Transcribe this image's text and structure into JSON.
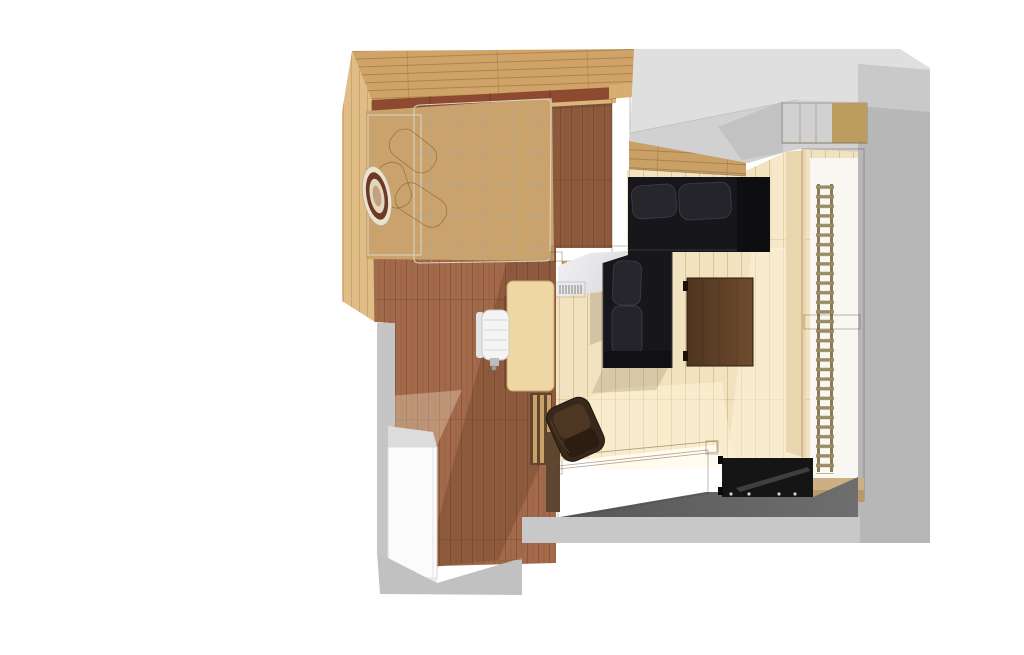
{
  "scene": {
    "title": "3D top-down floor plan render of a studio attic apartment",
    "style": "sketchup-like architectural rendering on white background"
  },
  "objects": {
    "bedroom_floor": "dark wood plank floor of sleeping area",
    "living_floor": "light cream wood floor of living area",
    "bed": "double bed with white quilted duvet",
    "mattress": "white sheet section of bed",
    "pillow": "caramel leather pillow",
    "hat": "round striped hat on bed",
    "balustrade": "wood loft railing beside bed",
    "knee_wall": "wood plank knee wall behind sofa",
    "sofa": "black L-shaped corner sofa",
    "coffee_table": "dark walnut coffee table",
    "lounge_chair": "brown leather lounge chair",
    "desk": "small light wood desk",
    "office_chair": "white office chair",
    "radiator": "small white radiator grille",
    "staircase": "wood staircase to lower level",
    "stair_rail": "wood stair handrail",
    "sideboard": "black lowboard at stair landing",
    "wardrobe": "white wardrobe cabinet",
    "window": "tall window with ladder rail",
    "wall_cabinet": "wood wall cabinet above window",
    "ceiling": "sloped gray attic ceiling planes",
    "lower_floor": "dark gray lower landing floor"
  },
  "colors": {
    "band_top": "#d0a468",
    "band_knee": "#c9a066",
    "strip_left": "#dfbd85",
    "wall_bed": "#8d4a31",
    "sill": "#d9b67c",
    "bed_frame": "#c9a36b",
    "floor_bedroom": "#a26a4b",
    "floor_living": "#f2e3c0",
    "rail_wood": "#d6ae72",
    "rail_gap": "#6e4a30",
    "rail_post": "#d2a96c",
    "mattress_light": "#fbfaf7",
    "mattress_shade": "#e6e3da",
    "duvet": "#fdfdfb",
    "pillow_light": "#dc9d60",
    "pillow_main": "#b5713b",
    "pillow_dark": "#8a4e22",
    "hat_base": "#eae2cb",
    "hat_ring": "#6a392a",
    "hat_inner": "#e3d7ba",
    "hat_center": "#c0a181",
    "ceiling_upper": "#dfdfdf",
    "ceiling_lower": "#d1d1d1",
    "ceiling_wedge": "#c2c2c2",
    "wall_right": "#b7b7b7",
    "wall_right_top": "#c9c9c9",
    "cabinet_wood": "#dbbc7e",
    "cabinet_wood_dark": "#bd9d5f",
    "window_jamb": "#ead6ae",
    "window_frame": "#c6a272",
    "glass": "#f8f7f2",
    "ladder": "#9b8b66",
    "ladder_rail": "#8a7a56",
    "crossbar": "#b89c6e",
    "sill_wood": "#ccb084",
    "sill_wood2": "#b89a6a",
    "sofa_base": "#17171b",
    "sofa_cushion": "#26262c",
    "sofa_cushion2": "#24242a",
    "sofa_arm": "#0e0e11",
    "sofa_armrest": "#101015",
    "table_dark": "#4e3420",
    "table_light": "#6f4c2e",
    "leather_dark": "#38281c",
    "leather_mid": "#4e3722",
    "leather_shadow": "#2c1d12",
    "stairs_tread": "#e0d2ab",
    "stairs_rail": "#dccb9f",
    "rail_slot": "#8f8060",
    "newel": "#cdb27f",
    "stair_base": "#5f4630",
    "sideboard": "#151515",
    "sideboard_shelf": "#3f3f3f",
    "floor_dark_a": "#575757",
    "floor_dark_b": "#6e6e6e",
    "band_light": "#c8c8c8",
    "wall_gray": "#c5c5c5",
    "cab_top": "#dcdcdc",
    "cabinet_white": "#fbfbfb",
    "cab_bottom": "#e9e9e9",
    "wedge_gray": "#c1c1c1",
    "desk": "#eed6a5",
    "chair_white": "#f4f4f4",
    "chair_back": "#e4e4e4",
    "pony_wedge_a": "#f2f2f4",
    "pony_wedge_b": "#dcdcde",
    "radiator": "#fcfcfc",
    "sun": "#fff6dc",
    "shadow_warm": "#9a8a72",
    "shadow_floor": "#4a2414"
  }
}
